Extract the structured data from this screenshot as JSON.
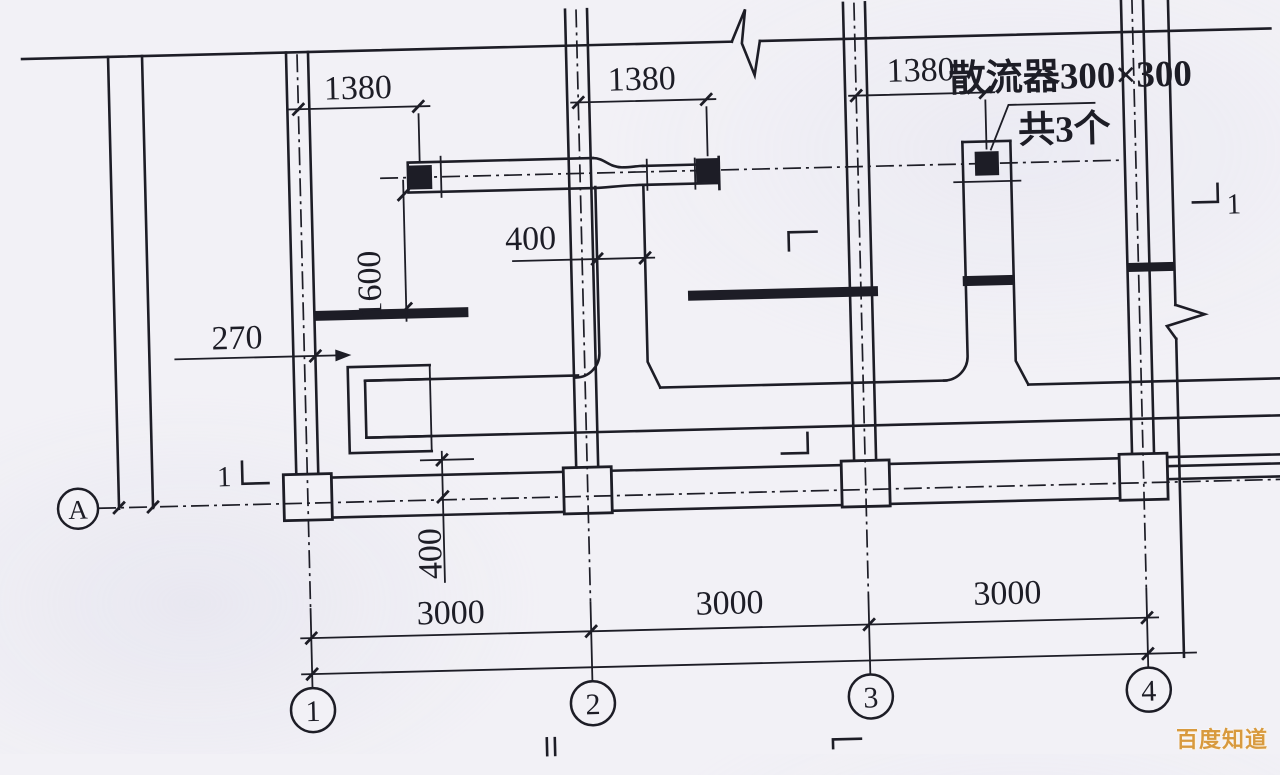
{
  "drawing": {
    "grid": {
      "row_label": "A",
      "columns": [
        "1",
        "2",
        "3",
        "4"
      ]
    },
    "dimensions": {
      "top_offsets": [
        "1380",
        "1380",
        "1380"
      ],
      "room_depth": "1600",
      "branch_offset": "400",
      "wall_offset": "270",
      "duct_offset": "400",
      "bays": [
        "3000",
        "3000",
        "3000"
      ]
    },
    "annotations": {
      "diffuser_label": "散流器300×300",
      "diffuser_count": "共3个",
      "section_mark_left": "1",
      "section_mark_right": "1"
    },
    "watermark": "百度知道",
    "colors": {
      "ink": "#1d1d26",
      "paper": "#f2f1f6",
      "watermark": "#d89a3e"
    }
  }
}
